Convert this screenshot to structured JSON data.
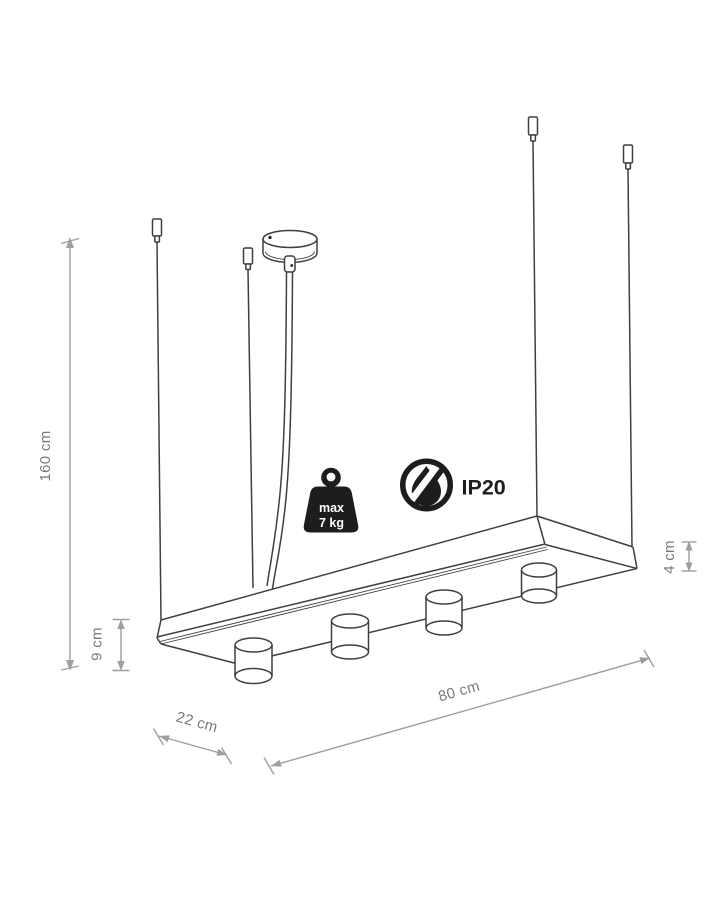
{
  "diagram": {
    "description": "Technical dimension drawing of a linear pendant ceiling lamp with four cylindrical spotlights, four suspension wires and a ceiling canopy",
    "background": "#ffffff"
  },
  "labels": {
    "height": "160 cm",
    "fixture_height": "9 cm",
    "panel_thickness": "4 cm",
    "length": "80 cm",
    "width": "22 cm"
  },
  "icons": {
    "max_weight": {
      "line1": "max",
      "line2": "7 kg"
    },
    "ip_rating": "IP20"
  },
  "colors": {
    "drawing_line": "#3f3f3f",
    "dimension_line": "#9e9e9e",
    "dimension_text": "#7a7a7a",
    "icon_black": "#1d1d1b",
    "background": "#ffffff"
  }
}
